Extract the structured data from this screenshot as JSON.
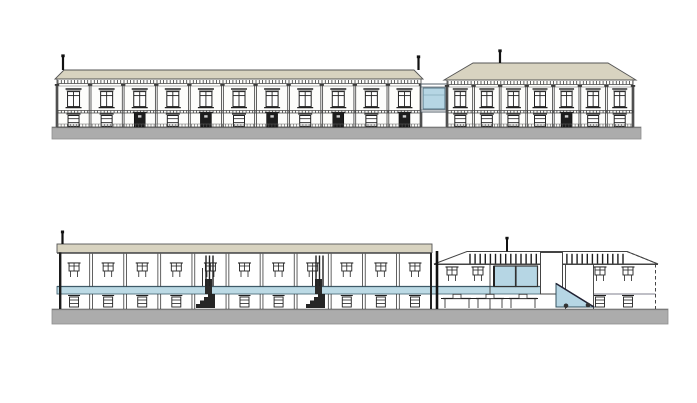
{
  "page": {
    "width": 697,
    "height": 403,
    "background": "#ffffff"
  },
  "colors": {
    "line": "#3a3a3a",
    "line_dark": "#1b1b1b",
    "roof_tan": "#d8d3c0",
    "glass_blue": "#b6d6e4",
    "slab_blue": "#bcdae5",
    "base_gray": "#acacac",
    "base_edge": "#8f8f8f",
    "wall_white": "#fdfdfb",
    "door_dark": "#1d1d1d"
  },
  "elevation": {
    "base": {
      "x": 52,
      "y": 127,
      "w": 589,
      "h": 12
    },
    "left_building": {
      "x": 57,
      "w": 364,
      "wall_top": 79,
      "wall_bottom": 127,
      "roof_top": 70,
      "roof_inset": 7,
      "bays": 11,
      "ground_pattern": [
        "window",
        "window",
        "door",
        "window",
        "door",
        "window",
        "door",
        "window",
        "door",
        "window",
        "door"
      ],
      "poles": [
        63,
        418.5
      ]
    },
    "bridge": {
      "x": 421,
      "w": 26,
      "top": 84,
      "bottom": 112,
      "glass_x": 423,
      "glass_y": 88,
      "glass_w": 22,
      "glass_h": 21
    },
    "right_building": {
      "x": 447,
      "w": 186,
      "wall_top": 80,
      "wall_bottom": 127,
      "roof_top": 63,
      "ridge_x1": 473,
      "ridge_x2": 608,
      "eave_x1": 444,
      "eave_x2": 636,
      "bays": 7,
      "ground_pattern": [
        "window",
        "window",
        "window",
        "window",
        "door",
        "window",
        "window"
      ],
      "poles": [
        500
      ]
    }
  },
  "section": {
    "base": {
      "x": 52,
      "y": 309,
      "w": 616,
      "h": 15
    },
    "slab": {
      "x": 57,
      "end": 541,
      "top": 286.5,
      "h": 7.5
    },
    "left_building": {
      "x": 57,
      "w": 375,
      "roof_top": 244,
      "roof_h": 8.5,
      "ceiling": 253.5,
      "bays": 11,
      "pole_x": 62.5,
      "stairs": [
        196,
        306
      ]
    },
    "right_building": {
      "eave_x1": 434,
      "eave_x2": 658,
      "eave_y": 264,
      "ridge_x1": 467,
      "ridge_x2": 627,
      "ridge_y": 251.5,
      "wall_x": 437,
      "right_wall_x": 655.5,
      "pole_x": 507,
      "rafters": {
        "x1": 470,
        "x2": 624,
        "step": 5.1,
        "y1": 253.8,
        "y2": 263.5
      },
      "boxes": [
        {
          "x": 494,
          "w": 21.5
        },
        {
          "x": 516,
          "w": 21.5
        }
      ],
      "panel": {
        "x": 540.5,
        "y": 252.5,
        "w": 22,
        "h": 41.5
      },
      "ramp": {
        "x1": 556,
        "y1": 283.5,
        "x2": 594,
        "y2": 307
      },
      "wheels": [
        [
          566,
          305.8
        ],
        [
          588,
          305
        ]
      ],
      "upper_windows": [
        452,
        478,
        600,
        628
      ],
      "tables": [
        457,
        490,
        523
      ],
      "lower_windows": [
        600,
        628
      ],
      "partitions": [
        490,
        565.5,
        593.5
      ]
    }
  }
}
